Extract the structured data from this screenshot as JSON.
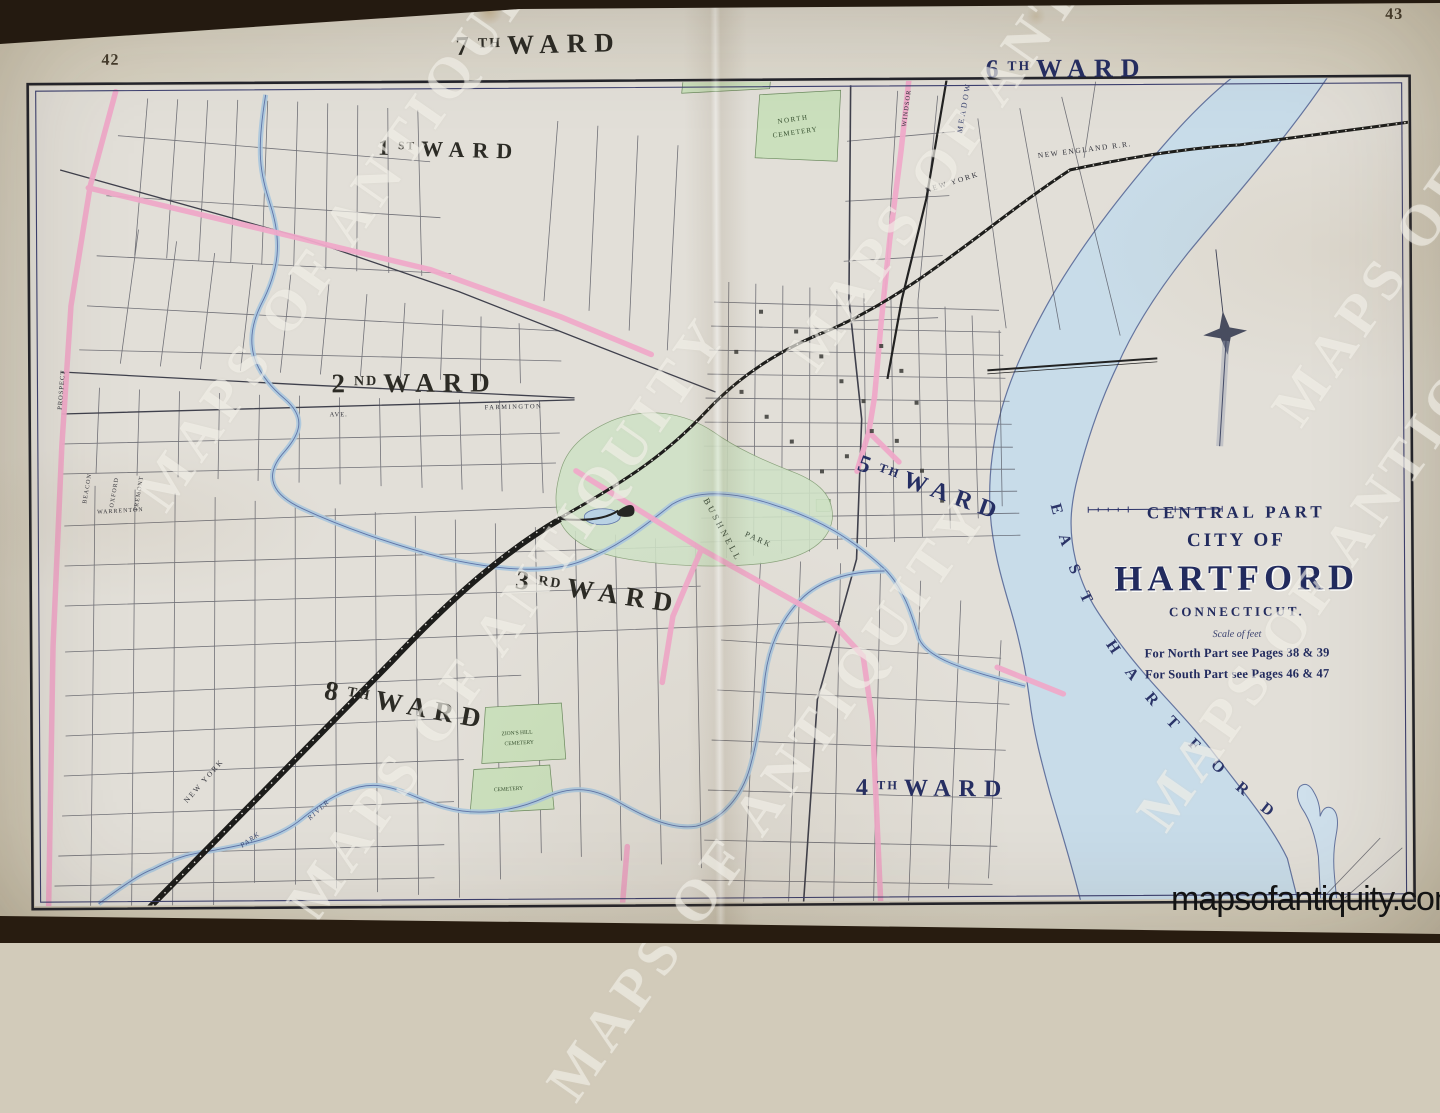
{
  "page": {
    "left_page_number": "42",
    "right_page_number": "43",
    "watermark": "MAPS OF ANTIQUITY",
    "website": "mapsofantiquity.com"
  },
  "title_block": {
    "line1": "CENTRAL PART",
    "line2": "CITY OF",
    "line3": "HARTFORD",
    "line4": "CONNECTICUT.",
    "scale_label": "Scale of feet",
    "note_north": "For North Part see Pages 38 & 39",
    "note_south": "For South Part see Pages 46 & 47"
  },
  "wards": {
    "w7": {
      "num": "7",
      "ord": "TH",
      "word": "WARD"
    },
    "w6": {
      "num": "6",
      "ord": "TH",
      "word": "WARD"
    },
    "w1": {
      "num": "1",
      "ord": "ST",
      "word": "WARD"
    },
    "w2": {
      "num": "2",
      "ord": "ND",
      "word": "WARD"
    },
    "w3": {
      "num": "3",
      "ord": "RD",
      "word": "WARD"
    },
    "w5": {
      "num": "5",
      "ord": "TH",
      "word": "WARD"
    },
    "w8": {
      "num": "8",
      "ord": "TH",
      "word": "WARD"
    },
    "w4": {
      "num": "4",
      "ord": "TH",
      "word": "WARD"
    }
  },
  "labels": {
    "east_hartford": "EAST HARTFORD",
    "bushnell": "BUSHNELL",
    "park": "PARK",
    "river": "RIVER",
    "meadow": "MEADOW",
    "north_cem_1": "NORTH",
    "north_cem_2": "CEMETERY",
    "stpat_1": "ST. PATRICK'S",
    "stpat_2": "& HOLY TRINITY",
    "stpat_3": "CEMETERY",
    "zion_1": "ZION'S HILL",
    "zion_2": "CEMETERY",
    "cemetery": "CEMETERY",
    "farmington": "FARMINGTON",
    "ave": "AVE.",
    "prospect": "PROSPECT",
    "beacon": "BEACON",
    "oxford": "OXFORD",
    "tremont": "TREMONT",
    "warrenton": "WARRENTON",
    "windsor": "WINDSOR",
    "new_york": "NEW YORK",
    "new_england_rr": "NEW ENGLAND R.R."
  },
  "colors": {
    "ink_navy": "#252e63",
    "ink_black": "#2c2b25",
    "river_blue": "#c8dce9",
    "park_green": "#cfe2c6",
    "road_pink": "#efa9c9",
    "paper": "#e0ddd5"
  }
}
